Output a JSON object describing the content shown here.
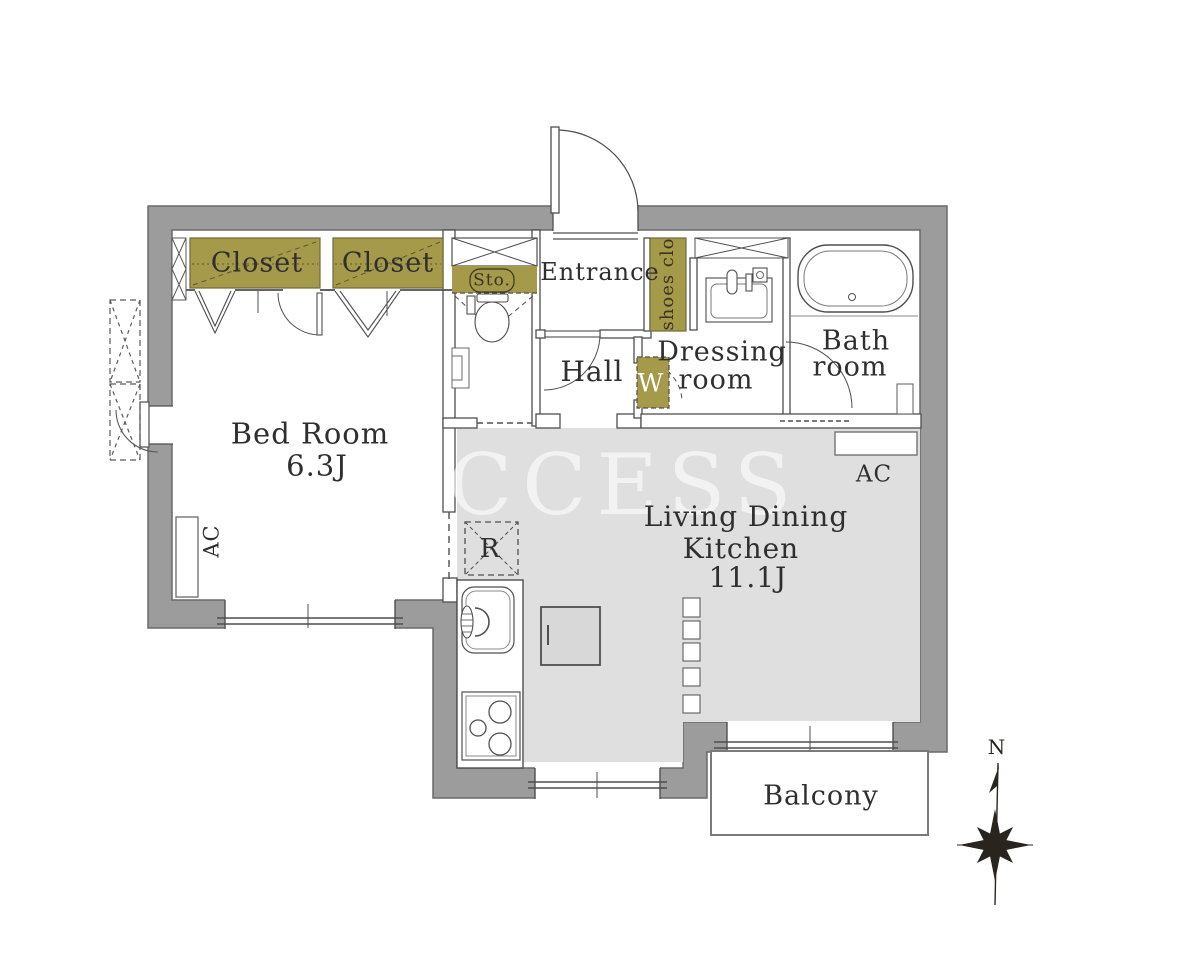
{
  "plan": {
    "watermark": "CCESS",
    "compass_north": "N",
    "rooms": {
      "bedroom_name": "Bed Room",
      "bedroom_size": "6.3J",
      "ldk_line1": "Living Dining",
      "ldk_line2": "Kitchen",
      "ldk_size": "11.1J",
      "entrance": "Entrance",
      "hall": "Hall",
      "dressing_line1": "Dressing",
      "dressing_line2": "room",
      "bath_line1": "Bath",
      "bath_line2": "room",
      "balcony": "Balcony"
    },
    "storage": {
      "closet_left": "Closet",
      "closet_right": "Closet",
      "storage_abbr": "Sto.",
      "shoes_closet": "shoes clo",
      "washer": "W",
      "refrigerator": "R"
    },
    "equipment": {
      "ac_bedroom": "AC",
      "ac_ldk": "AC"
    },
    "colors": {
      "wall_gray": "#9c9c9c",
      "accent_olive": "#a5994a",
      "floor_gray": "#dfdfdf",
      "line": "#4f4f4f"
    }
  }
}
